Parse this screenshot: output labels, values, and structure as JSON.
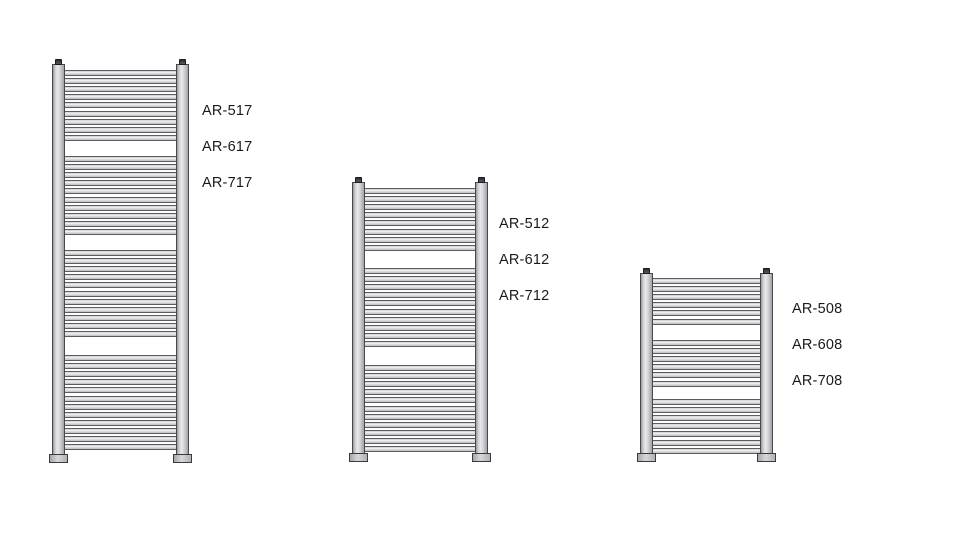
{
  "page": {
    "background_color": "#ffffff",
    "description": "Size comparison diagram of three ladder towel radiators with model codes"
  },
  "diagram": {
    "type": "towel-radiator-size-diagram",
    "geometry": {
      "bar_pitch": 8.1,
      "bar_height": 6,
      "rail_width": 13
    },
    "colors": {
      "outline": "#48484c",
      "metal_light": "#e9e9ed",
      "metal_mid": "#cfcfd3",
      "metal_dark": "#a2a2a6",
      "cap_dark": "#2e2e32",
      "label_text": "#1a1a1a",
      "background": "#ffffff"
    },
    "radiators": [
      {
        "id": "radiator-tall",
        "x": 52,
        "top": 64,
        "bottom": 462,
        "width": 137,
        "bar_groups": [
          {
            "start": 6,
            "count": 9
          },
          {
            "start": 92,
            "count": 10
          },
          {
            "start": 186,
            "count": 11
          },
          {
            "start": 291,
            "count": 12
          }
        ],
        "models": [
          {
            "label": "AR-517",
            "x": 202,
            "y": 104
          },
          {
            "label": "AR-617",
            "x": 202,
            "y": 140
          },
          {
            "label": "AR-717",
            "x": 202,
            "y": 176
          }
        ]
      },
      {
        "id": "radiator-medium",
        "x": 352,
        "top": 182,
        "bottom": 461,
        "width": 136,
        "bar_groups": [
          {
            "start": 6,
            "count": 8
          },
          {
            "start": 86,
            "count": 10
          },
          {
            "start": 183,
            "count": 11
          }
        ],
        "models": [
          {
            "label": "AR-512",
            "x": 499,
            "y": 217
          },
          {
            "label": "AR-612",
            "x": 499,
            "y": 253
          },
          {
            "label": "AR-712",
            "x": 499,
            "y": 289
          }
        ]
      },
      {
        "id": "radiator-short",
        "x": 640,
        "top": 273,
        "bottom": 461,
        "width": 133,
        "bar_groups": [
          {
            "start": 5,
            "count": 6
          },
          {
            "start": 67,
            "count": 6
          },
          {
            "start": 126,
            "count": 7
          }
        ],
        "models": [
          {
            "label": "AR-508",
            "x": 792,
            "y": 302
          },
          {
            "label": "AR-608",
            "x": 792,
            "y": 338
          },
          {
            "label": "AR-708",
            "x": 792,
            "y": 374
          }
        ]
      }
    ]
  }
}
